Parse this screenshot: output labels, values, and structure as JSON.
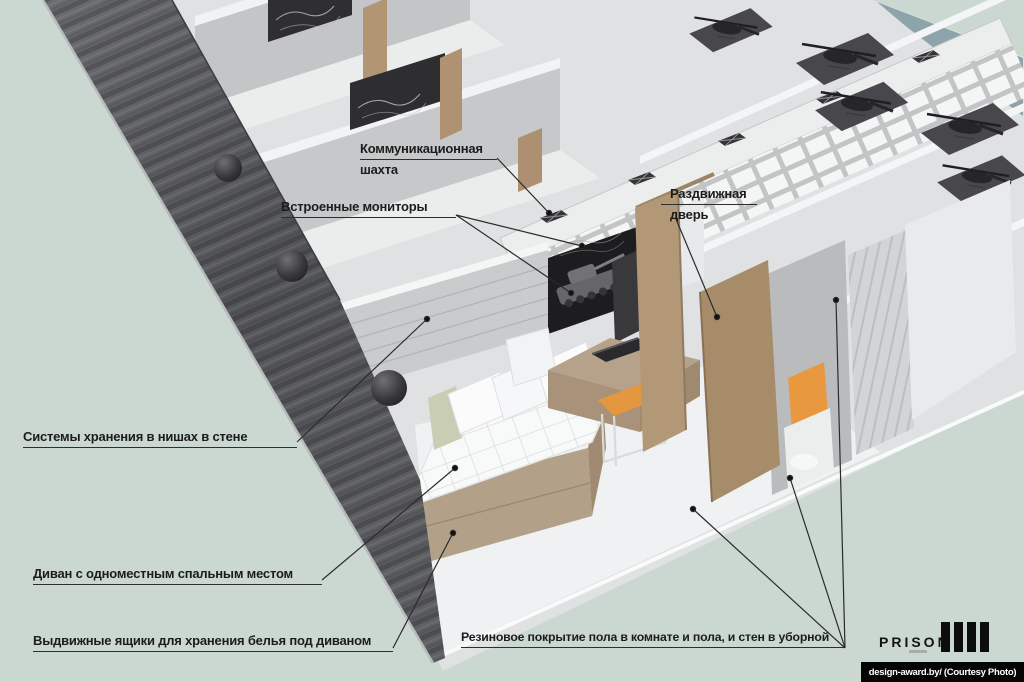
{
  "scene": {
    "description": "3D cutaway rendering of a modular prison cell block concept",
    "background_color": "#cbd8d1",
    "colors": {
      "dark_exterior_wall": "#55565a",
      "cell_wall_gray": "#c6c8ca",
      "wood_tan": "#ab9172",
      "chair_orange": "#e5973f",
      "towel_orange": "#e8993f",
      "monitor_dark": "#1d1d1f",
      "watermark_bg": "#040404"
    }
  },
  "annotations": {
    "comm_shaft": {
      "line1": "Коммуникационная",
      "line2": "шахта"
    },
    "built_in_monitors": {
      "label": "Встроенные мониторы"
    },
    "sliding_door": {
      "line1": "Раздвижная",
      "line2": "дверь"
    },
    "wall_storage": {
      "label": "Системы хранения в нишах в стене"
    },
    "sofa_bed": {
      "label": "Диван с одноместным спальным местом"
    },
    "linen_drawers": {
      "label": "Выдвижные ящики для хранения белья под диваном"
    },
    "rubber_floor": {
      "label": "Резиновое покрытие пола в комнате и пола, и стен в уборной"
    }
  },
  "branding": {
    "logo_text": "PRISON"
  },
  "watermark": {
    "credit_text": "design-award.by/ (Courtesy Photo)"
  }
}
